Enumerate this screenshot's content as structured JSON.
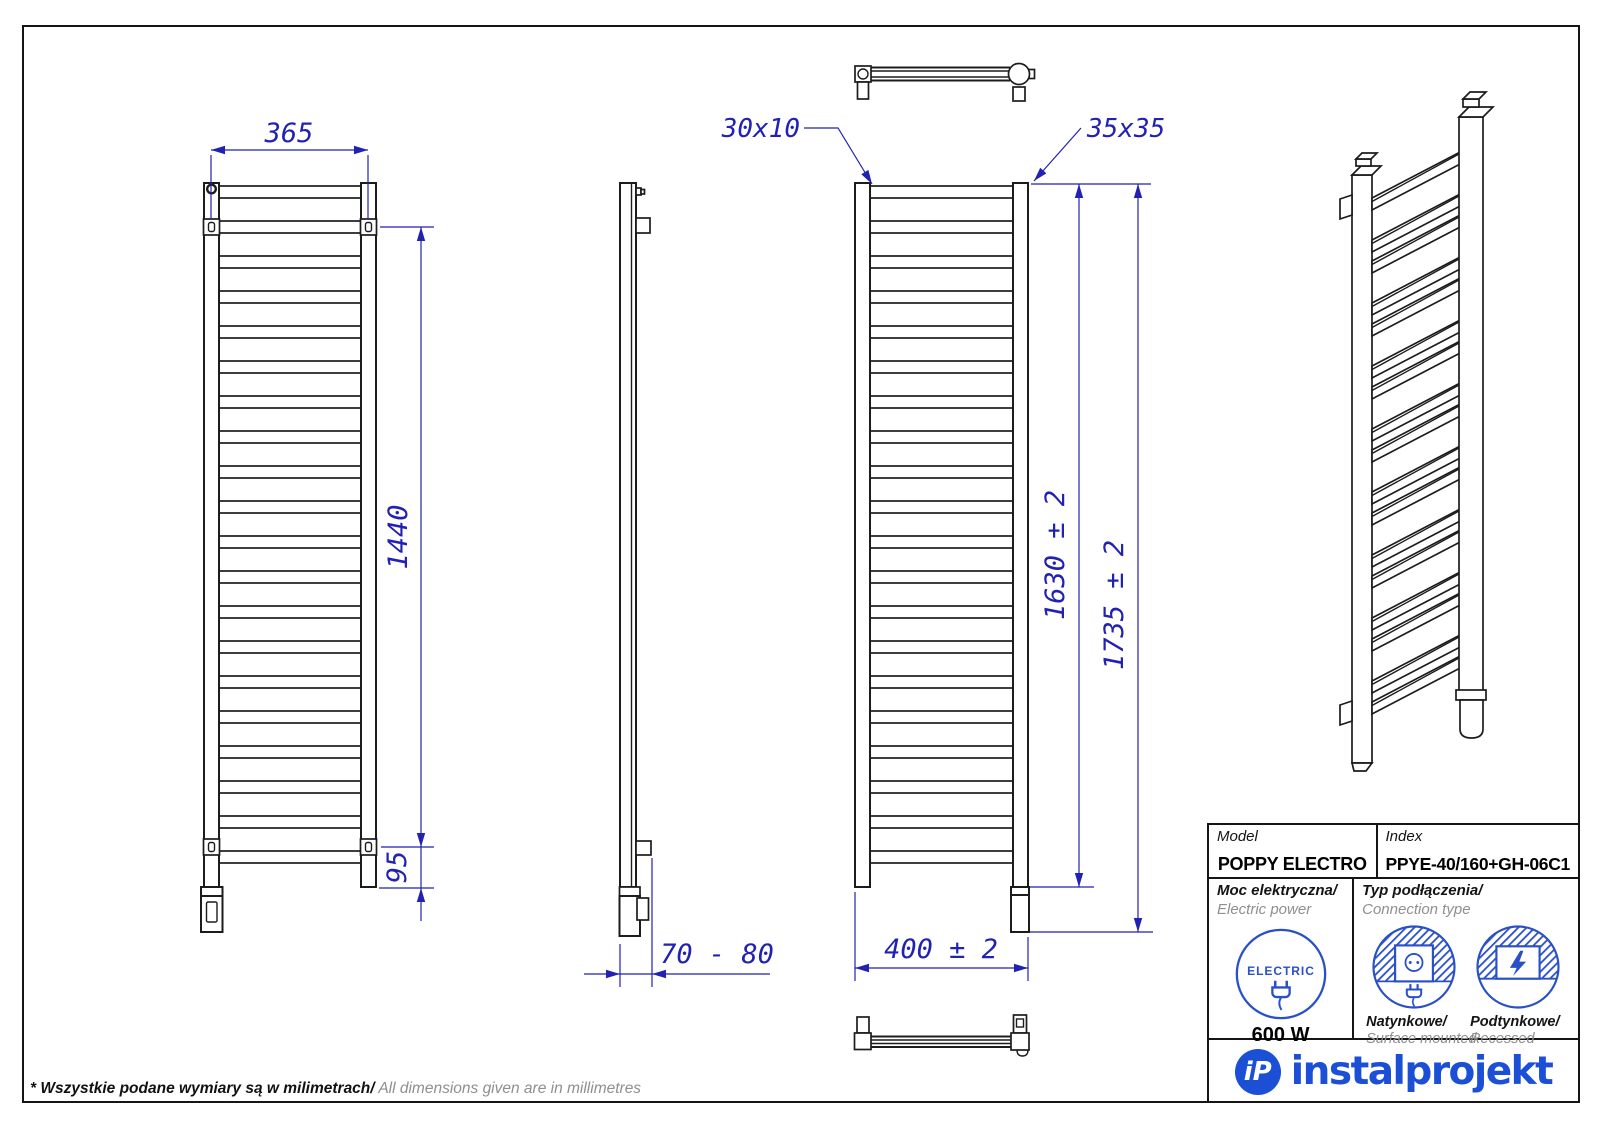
{
  "colors": {
    "line": "#1c1c1c",
    "dim": "#2222b2",
    "icon": "#2a50c8",
    "logo": "#1b4fd6",
    "muted": "#8f8f8f"
  },
  "dimensions": {
    "bracket_width": "365",
    "bracket_height": "1440",
    "bottom_offset": "95",
    "depth": "70 - 80",
    "rung_profile": "30x10",
    "tube_profile": "35x35",
    "collector_height": "1630 ± 2",
    "total_height": "1735 ± 2",
    "total_width": "400 ± 2"
  },
  "title_block": {
    "model_label": "Model",
    "model_value": "POPPY ELECTRO",
    "index_label": "Index",
    "index_value": "PPYE-40/160+GH-06C1",
    "power_label_pl": "Moc elektryczna/",
    "power_label_en": " Electric power",
    "power_value": "600 W",
    "electric_badge": "ELECTRIC",
    "connection_label_pl": "Typ podłączenia/",
    "connection_label_en": "Connection type",
    "surface_label_pl": "Natynkowe/",
    "surface_label_en": "Surface mounted",
    "recessed_label_pl": "Podtynkowe/",
    "recessed_label_en": "Recessed"
  },
  "logo": {
    "monogram": "iP",
    "name": "instalprojekt"
  },
  "footnote": {
    "pl": "* Wszystkie podane wymiary są w milimetrach/",
    "en": " All dimensions given are in millimetres"
  }
}
